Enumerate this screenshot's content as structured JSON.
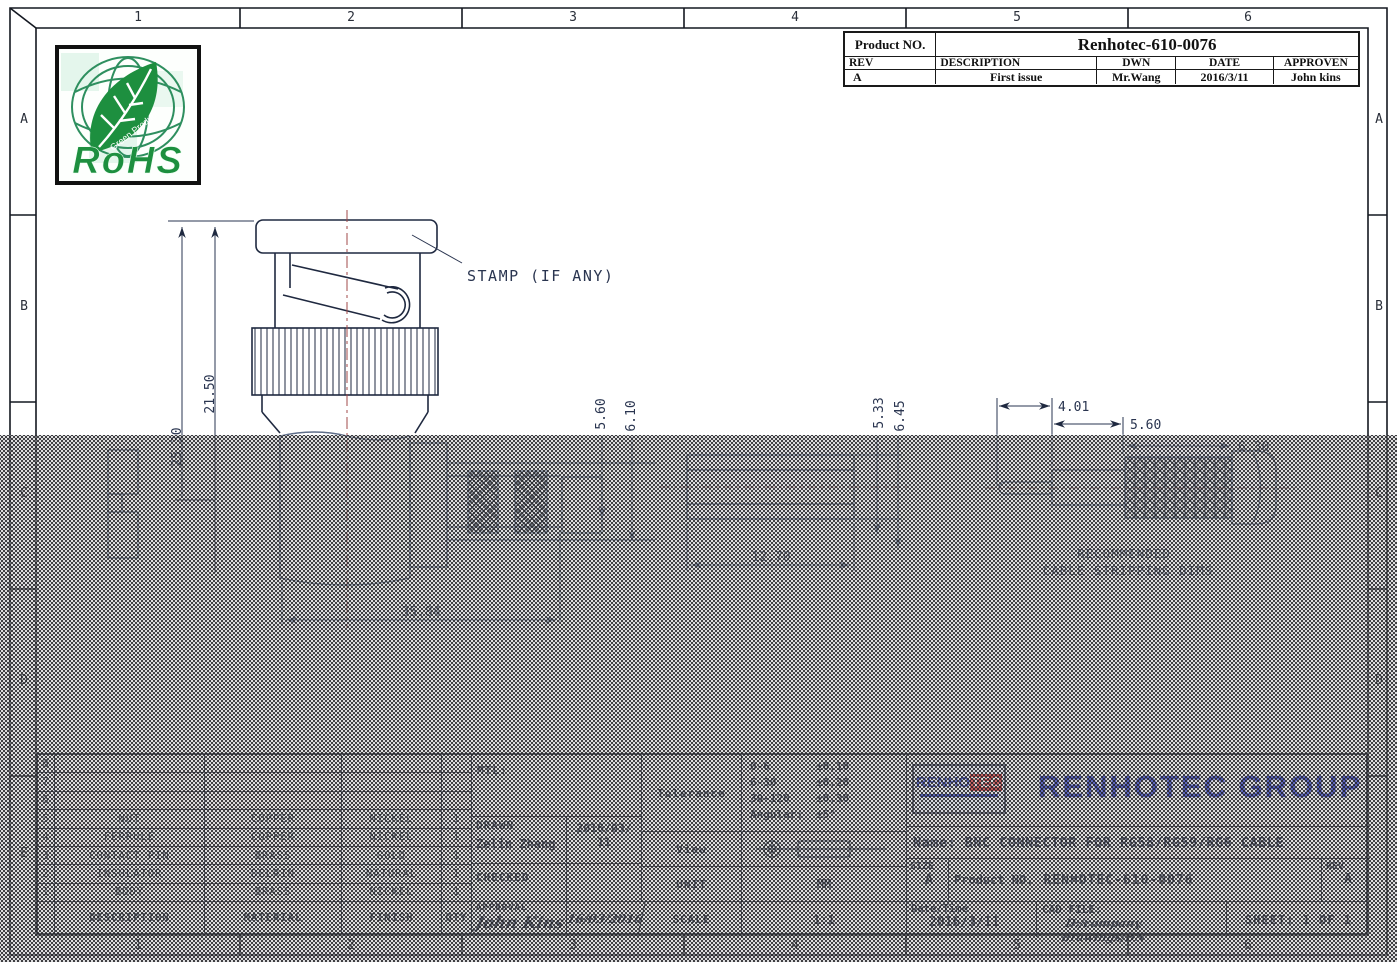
{
  "frame": {
    "top_labels": [
      "1",
      "2",
      "3",
      "4",
      "5",
      "6"
    ],
    "bottom_labels": [
      "1",
      "2",
      "3",
      "4",
      "5",
      "6"
    ],
    "left_labels": [
      "A",
      "B",
      "C",
      "D",
      "E"
    ],
    "right_labels": [
      "A",
      "B",
      "C",
      "D",
      "E"
    ]
  },
  "rohs": {
    "title": "RoHS",
    "leaf_text": "Green Product"
  },
  "revision_table": {
    "product_no_label": "Product NO.",
    "product_no_value": "Renhotec-610-0076",
    "col_rev": "REV",
    "col_description": "DESCRIPTION",
    "col_dwn": "DWN",
    "col_date": "DATE",
    "col_approven": "APPROVEN",
    "val_rev": "A",
    "val_description": "First issue",
    "val_dwn": "Mr.Wang",
    "val_date": "2016/3/11",
    "val_approven": "John kins"
  },
  "drawing": {
    "stamp_note": "STAMP (IF ANY)",
    "recommended_line1": "RECOMMENDED",
    "recommended_line2": "CABLE STRIPPING DIMS",
    "dims": {
      "height_outer": "25.30",
      "height_inner": "21.50",
      "body_length": "35.84",
      "knurl_id": "5.60",
      "knurl_od": "6.10",
      "cable_id": "5.33",
      "cable_od": "6.45",
      "cable_strip": "12.70",
      "strip_pin": "4.01",
      "strip_jacket": "5.60",
      "strip_braid": "6.30"
    }
  },
  "bom": {
    "col_description": "DESCRIPTION",
    "col_material": "MATERIAL",
    "col_finish": "FINISH",
    "col_qty": "QTY",
    "items": [
      {
        "no": "8",
        "description": "",
        "material": "",
        "finish": "",
        "qty": ""
      },
      {
        "no": "7",
        "description": "",
        "material": "",
        "finish": "",
        "qty": ""
      },
      {
        "no": "6",
        "description": "",
        "material": "",
        "finish": "",
        "qty": ""
      },
      {
        "no": "5",
        "description": "NUT",
        "material": "COPPER",
        "finish": "NICKEL",
        "qty": "1"
      },
      {
        "no": "4",
        "description": "FERRULE",
        "material": "COPPER",
        "finish": "NICKEL",
        "qty": "1"
      },
      {
        "no": "3",
        "description": "CONTACT PIN",
        "material": "BRASS",
        "finish": "GOLD",
        "qty": "1"
      },
      {
        "no": "2",
        "description": "INSULATOR",
        "material": "DELRIN",
        "finish": "NATURAL",
        "qty": "1"
      },
      {
        "no": "1",
        "description": "BODY",
        "material": "BRASS",
        "finish": "NICKEL",
        "qty": "1"
      }
    ]
  },
  "title_block": {
    "mtl_label": "MTL:",
    "tolerance_label": "Tolerance",
    "tol": [
      {
        "range": "0-6",
        "value": "±0.10"
      },
      {
        "range": "6-30",
        "value": "±0.20"
      },
      {
        "range": "30-120",
        "value": "±0.30"
      },
      {
        "range": "Angular:",
        "value": "±5°"
      }
    ],
    "drawn_label": "DRAWN",
    "drawn_name": "Zelin Zhang",
    "drawn_date_top": "2016/03/",
    "drawn_date_bottom": "11",
    "view_label": "View",
    "checked_label": "CHECKED",
    "unit_label": "UNIT",
    "unit_value": "MM",
    "approval_label": "APPROVAL",
    "approval_signature": "John Kins",
    "approval_date": "16/03/2016",
    "scale_label": "SCALE",
    "scale_value": "1:1",
    "logo_part1": "RENHO",
    "logo_part2": "TEC",
    "company": "RENHOTEC GROUP",
    "name_line": "Name: BNC CONNECTOR FOR RG58/RG59/RG6 CABLE",
    "size_label": "SIZE",
    "size_value": "A",
    "product_label": "Product NO.",
    "product_value": "RENHOTEC-610-0076",
    "rev_label": "REV",
    "rev_value": "A",
    "datetime_label": "Date/Time",
    "datetime_value": "2016/3/11",
    "cad_label": "CAD FILE:",
    "cad_value": "D:/company drawings/BN",
    "sheet_value": "SHEET: 1 OF 1"
  },
  "colors": {
    "line_dark": "#1f2940",
    "line_faded": "#5f6e8a",
    "centerline": "#a04848",
    "brand_blue": "#2733c4",
    "brand_red": "#d42b2b",
    "rohs_green": "#1d8f3f"
  }
}
